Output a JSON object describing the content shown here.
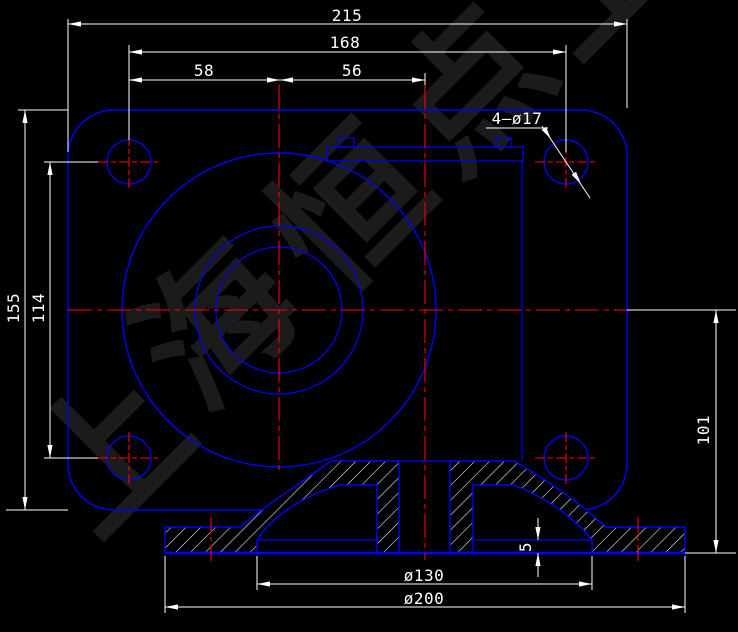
{
  "colors": {
    "background": "#000000",
    "geometry": "#0000ff",
    "centerline": "#ff0000",
    "dimension": "#ffffff",
    "hatch": "#ffffff",
    "watermark": "#1b1b1b"
  },
  "dimensions": {
    "total_width": "215",
    "hole_span_width": "168",
    "center_left": "58",
    "center_right": "56",
    "total_height": "155",
    "hole_span_height": "114",
    "base_height": "101",
    "hole_callout": "4—ø17",
    "recess_depth": "5",
    "recess_diameter": "ø130",
    "base_diameter": "ø200"
  },
  "watermark": {
    "text": "上海恒点",
    "chars": [
      "上",
      "海",
      "恒",
      "点",
      "上"
    ]
  }
}
